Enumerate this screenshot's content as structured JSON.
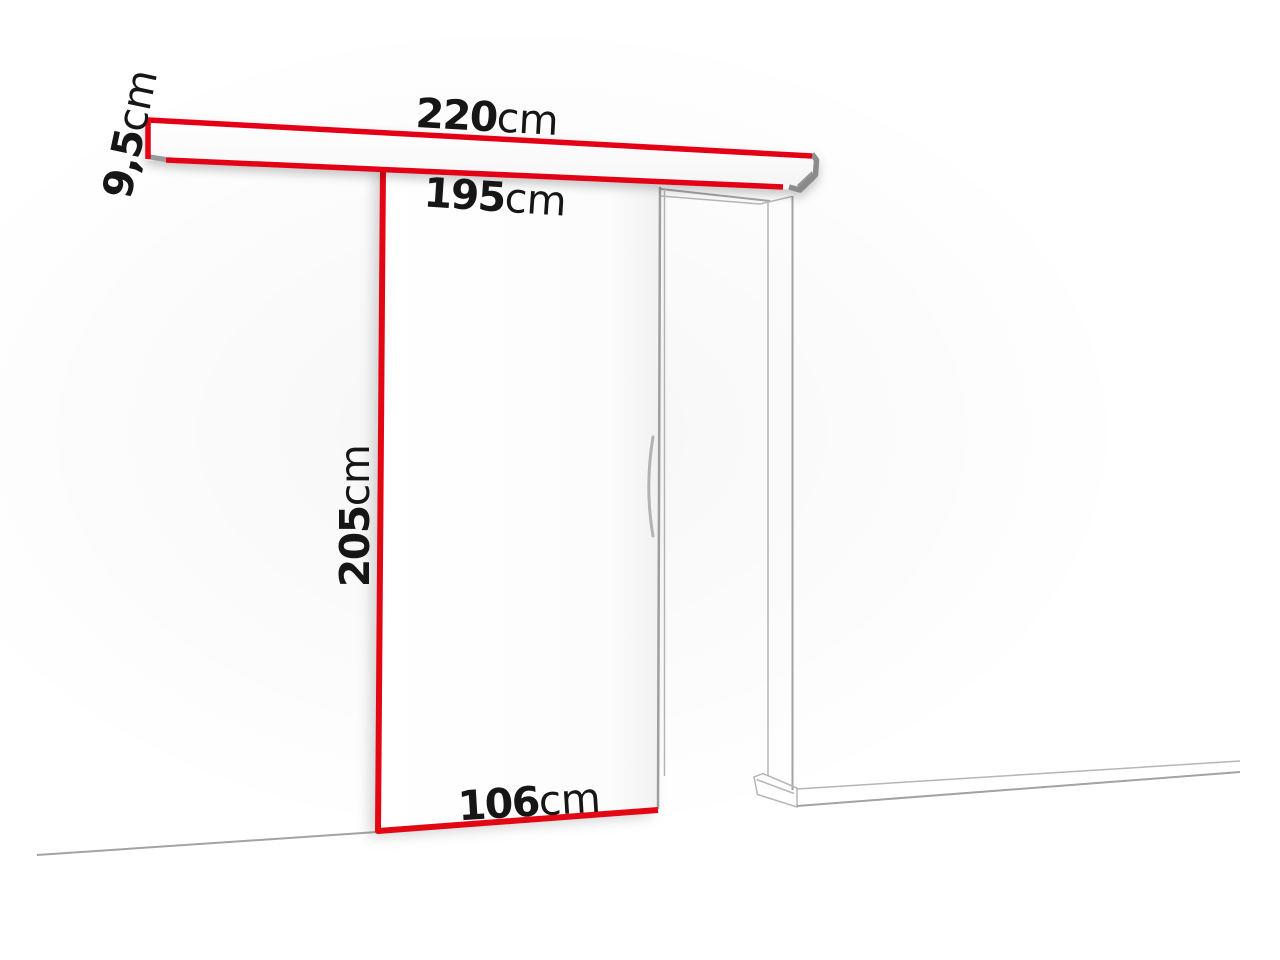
{
  "labels": {
    "rail_length": {
      "value": "220",
      "unit": "cm"
    },
    "rail_height": {
      "value": "9,5",
      "unit": "cm"
    },
    "opening_width": {
      "value": "195",
      "unit": "cm"
    },
    "door_height": {
      "value": "205",
      "unit": "cm"
    },
    "door_width": {
      "value": "106",
      "unit": "cm"
    }
  },
  "colors": {
    "highlight_red": "#e30613",
    "outline_gray": "#a3a3a3",
    "text_black": "#161616",
    "background": "#ffffff"
  }
}
